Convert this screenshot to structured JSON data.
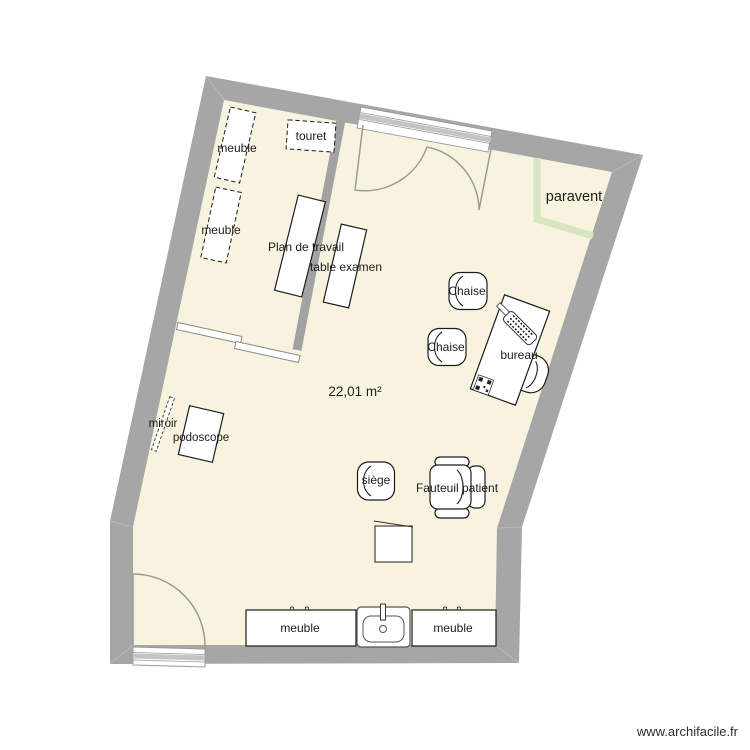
{
  "app": {
    "watermark": "www.archifacile.fr"
  },
  "room": {
    "area": "22,01 m²"
  },
  "colors": {
    "wall": "#a6a6a6",
    "floor": "#f8f3de",
    "paravent": "#d9e5c2",
    "opening": "#9a9a9a",
    "window_stripe": "#c4c4c4"
  },
  "furniture": {
    "meuble_top_1": "meuble",
    "meuble_top_2": "meuble",
    "touret": "touret",
    "plan_de_travail": "Plan de travail",
    "table_examen": "table examen",
    "chaise_1": "Chaise",
    "chaise_2": "Chaise",
    "bureau": "bureau",
    "paravent": "paravent",
    "miroir": "miroir",
    "podoscope": "podoscope",
    "siege": "siège",
    "fauteuil_patient": "Fauteuil patient",
    "meuble_bottom_left": "meuble",
    "meuble_bottom_right": "meuble"
  }
}
